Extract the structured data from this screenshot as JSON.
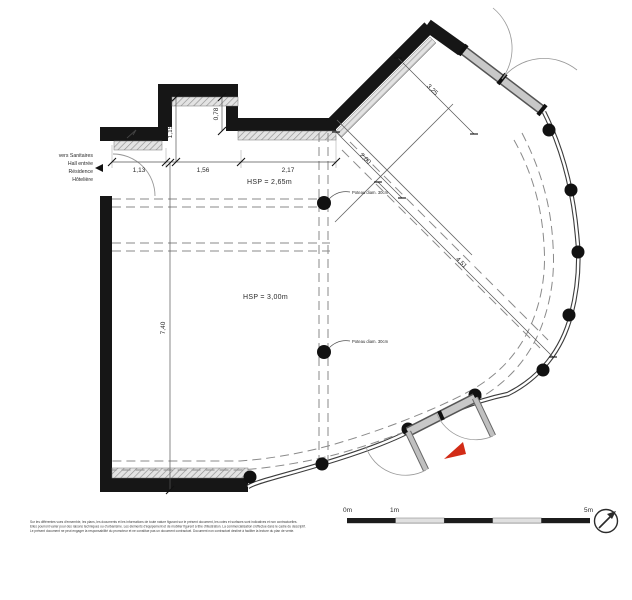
{
  "annotations": {
    "left_note": [
      "vers Sanitaires",
      "Hall entrée",
      "Résidence",
      "Hôtelière"
    ],
    "hsp_upper": "HSP = 2,65m",
    "hsp_lower": "HSP = 3,00m",
    "poteau_label": "Poteau diam. 30cm"
  },
  "dimensions": {
    "top_chain": [
      "1,13",
      "1,56",
      "2,17"
    ],
    "niche_height": "1,15",
    "step_height": "0,78",
    "room_height": "7,40",
    "diag_upper": "3,25",
    "diag_mid": "2,00",
    "diag_long": "4,51"
  },
  "scale_bar": {
    "labels": [
      "0m",
      "1m",
      "5m"
    ]
  },
  "icons": {
    "north_arrow": "compass-needle-icon",
    "direction_arrow": "left-triangle-icon",
    "entrance_marker": "red-arrowhead-icon"
  },
  "disclaimer": [
    "Sur les différentes vues d'ensemble, les plans, les documents et les informations de toute nature figurant sur le présent document, les cotes et surfaces sont indicatives et non contractuelles.",
    "Elles pourront varier pour des raisons techniques ou d'urbanisme. Les éléments d'équipement et de mobilier figurent à titre d'illustration. La commercialisation s'effectue dans le cadre du descriptif.",
    "Le présent document ne peut engager la responsabilité du promoteur et ne constitue pas un document contractuel. Document non contractuel destiné à faciliter la lecture du plan de vente."
  ],
  "colors": {
    "wall": "#161616",
    "hatch": "#8f8f8f",
    "dashed": "#8a8a8a",
    "door": "#c8c8c8",
    "entrance_marker": "#d22b16"
  }
}
